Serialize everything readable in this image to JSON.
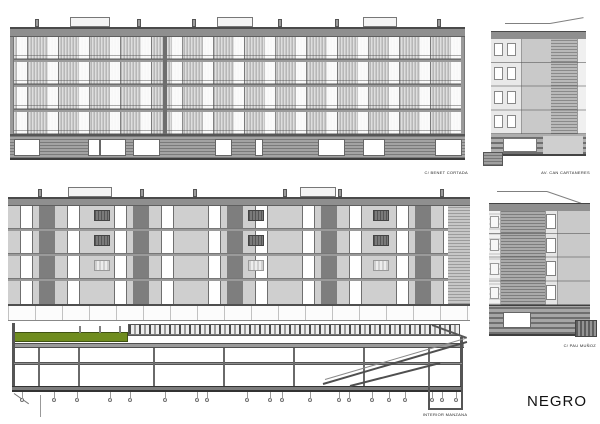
{
  "project": {
    "name": "NEGRO"
  },
  "document": {
    "type": "architectural elevations and section sheet"
  },
  "labels": {
    "top_elevation": "C/ BENET CORTADA",
    "top_side_elevation": "AV. CAN CARTANERES",
    "section": "INTERIOR MANZANA",
    "bottom_side_elevation": "C/ PAU MUÑOZ"
  },
  "colors": {
    "background": "#ffffff",
    "facade_band": "#8f8f8f",
    "panel_light": "#cfcfcf",
    "siding_dark": "#7d7d7d",
    "green_roof_strip": "#6f8c1f",
    "line_dark": "#4a4a4a",
    "text": "#1a1a1a"
  }
}
